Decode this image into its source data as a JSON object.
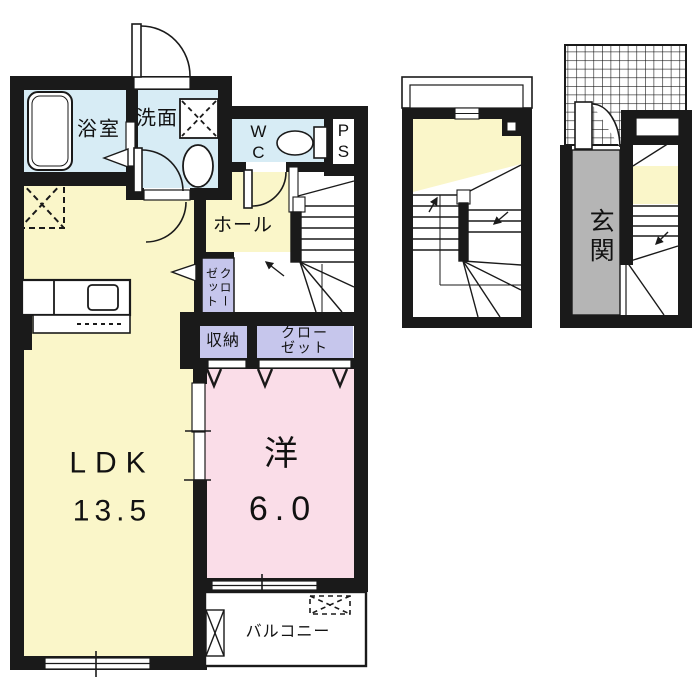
{
  "page": {
    "background": "#ffffff",
    "border_color": "#c8c8c8",
    "kind": "apartment floor plan"
  },
  "palette": {
    "wall": "#1a1a1a",
    "wet_area": "#d7ecf5",
    "living": "#faf6c9",
    "bedroom": "#fadde8",
    "closet": "#c6c6ec",
    "entrance_floor": "#b5b5b5",
    "white": "#ffffff"
  },
  "main_plan": {
    "rooms": {
      "bath": {
        "label": "浴室"
      },
      "washroom": {
        "label": "洗面"
      },
      "toilet": {
        "label": "WC"
      },
      "pipe_space": {
        "label": "PS"
      },
      "hall": {
        "label": "ホール"
      },
      "hall_closet": {
        "label": "クローゼット",
        "display_columns": [
          "ゼット",
          "クロー"
        ]
      },
      "storage": {
        "label": "収納"
      },
      "bedroom_closet": {
        "label": "クローゼット",
        "display_lines": [
          "クロー",
          "ゼット"
        ]
      },
      "ldk": {
        "label": "LDK",
        "size_tatami": "13.5"
      },
      "western_room": {
        "label": "洋",
        "size_tatami": "6.0"
      },
      "balcony": {
        "label": "バルコニー"
      }
    },
    "fixture_icons": [
      "bathtub-icon",
      "washing-machine-space-icon",
      "wash-basin-icon",
      "toilet-bowl-icon",
      "refrigerator-space-icon",
      "kitchen-counter-icon",
      "sink-icon",
      "staircase-icon",
      "door-swing-icon",
      "sliding-door-arrow-icon",
      "window-icon"
    ]
  },
  "sub_plans": {
    "stair_plan": {
      "fixture_icons": [
        "staircase-icon",
        "bay-window-icon",
        "up-arrow-icon",
        "down-arrow-icon"
      ]
    },
    "entrance_plan": {
      "rooms": {
        "entrance": {
          "label": "玄関"
        }
      },
      "fixture_icons": [
        "tiled-porch-icon",
        "entrance-door-swing-icon",
        "staircase-icon",
        "window-icon"
      ]
    }
  }
}
